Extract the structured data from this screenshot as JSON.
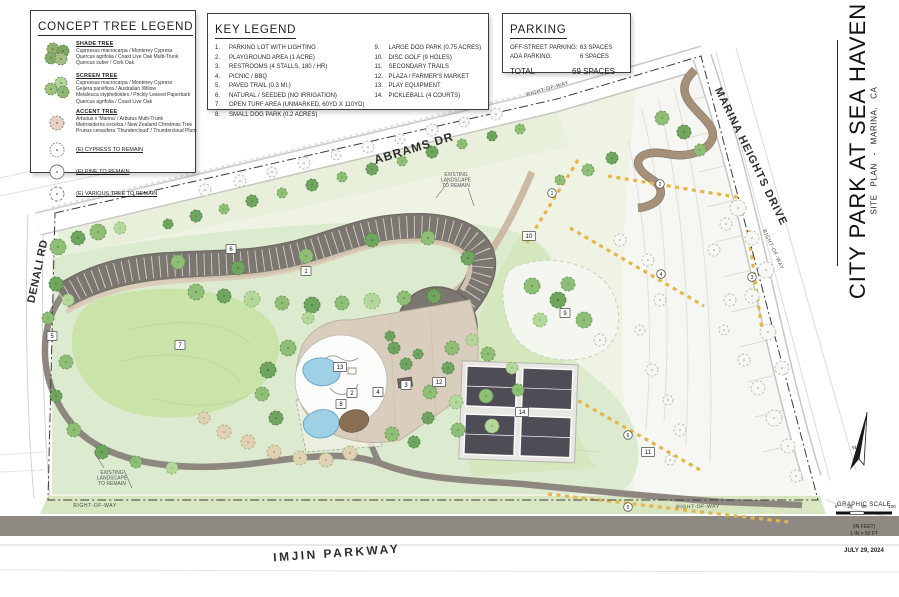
{
  "title_block": {
    "project_title": "CITY PARK AT SEA HAVEN",
    "subtitle": "SITE PLAN - MARINA, CA",
    "date": "JULY 29, 2024",
    "north_label": "N",
    "scale": {
      "heading": "GRAPHIC SCALE",
      "ticks": [
        "0",
        "25",
        "50",
        "100"
      ],
      "unit_note": "(IN FEET)",
      "ratio_note": "1 IN = 50 FT"
    }
  },
  "tree_legend": {
    "title": "CONCEPT TREE LEGEND",
    "groups": [
      {
        "name": "SHADE TREE",
        "icon": "shade-tree-cluster-icon",
        "species": [
          "Cupressus macrocarpa / Monterey Cypress",
          "Quercus agrifolia / Coast Live Oak Multi-Trunk",
          "Quercus suber / Cork Oak"
        ]
      },
      {
        "name": "SCREEN TREE",
        "icon": "screen-tree-cluster-icon",
        "species": [
          "Cupressus macrocarpa / Monterey Cypress",
          "Geijera parviflora / Australian Willow",
          "Melaleuca styphelioides / Prickly Leaved Paperbark",
          "Quercus agrifolia / Coast Live Oak"
        ]
      },
      {
        "name": "ACCENT TREE",
        "icon": "accent-tree-icon",
        "species": [
          "Arbutus x 'Marina' / Arbutus Multi-Trunk",
          "Metrosideros excelsa / New Zealand Christmas Tree",
          "Prunus cerasifera 'Thundercloud' / Thundercloud Plum"
        ]
      }
    ],
    "existing": [
      {
        "label": "(E) CYPRESS TO REMAIN",
        "icon": "existing-cypress-symbol-icon"
      },
      {
        "label": "(E) PINE TO REMAIN",
        "icon": "existing-pine-symbol-icon"
      },
      {
        "label": "(E) VARIOUS TREE TO REMAIN",
        "icon": "existing-various-symbol-icon"
      }
    ]
  },
  "key_legend": {
    "title": "KEY LEGEND",
    "items": [
      {
        "num": "1.",
        "label": "PARKING LOT WITH LIGHTING"
      },
      {
        "num": "2.",
        "label": "PLAYGROUND AREA (1 ACRE)"
      },
      {
        "num": "3.",
        "label": "RESTROOMS (4 STALLS, 180 / HR)"
      },
      {
        "num": "4.",
        "label": "PICNIC / BBQ"
      },
      {
        "num": "5.",
        "label": "PAVED TRAIL (0.3 MI.)"
      },
      {
        "num": "6.",
        "label": "NATURAL / SEEDED (NO IRRIGATION)"
      },
      {
        "num": "7.",
        "label": "OPEN TURF AREA  (UNMARKED, 60YD X 110YD)"
      },
      {
        "num": "8.",
        "label": "SMALL DOG PARK (0.2 ACRES)"
      },
      {
        "num": "9.",
        "label": "LARGE DOG PARK (0.75 ACRES)"
      },
      {
        "num": "10.",
        "label": "DISC GOLF (9 HOLES)"
      },
      {
        "num": "11.",
        "label": "SECONDARY TRAILS"
      },
      {
        "num": "12.",
        "label": "PLAZA / FARMER'S MARKET"
      },
      {
        "num": "13.",
        "label": "PLAY EQUIPMENT"
      },
      {
        "num": "14.",
        "label": "PICKLEBALL (4 COURTS)"
      }
    ]
  },
  "parking": {
    "title": "PARKING",
    "rows": [
      {
        "label": "OFF-STREET PARKING:",
        "value": "63 SPACES"
      },
      {
        "label": "ADA PARKING:",
        "value": "6 SPACES"
      }
    ],
    "total_label": "TOTAL",
    "total_value": "69 SPACES"
  },
  "map": {
    "road_labels": [
      {
        "text": "ABRAMS DR",
        "x": 415,
        "y": 152,
        "rot": -17,
        "size": 12,
        "ls": 1
      },
      {
        "text": "MARINA HEIGHTS DRIVE",
        "x": 748,
        "y": 158,
        "rot": 64,
        "size": 11,
        "ls": 1
      },
      {
        "text": "DENALI RD",
        "x": 41,
        "y": 272,
        "rot": -78,
        "size": 11,
        "ls": 0.5
      },
      {
        "text": "IMJIN PARKWAY",
        "x": 337,
        "y": 557,
        "rot": -4,
        "size": 12,
        "ls": 2.5
      }
    ],
    "row_labels": [
      {
        "text": "RIGHT-OF-WAY",
        "x": 95,
        "y": 507,
        "rot": 0
      },
      {
        "text": "RIGHT-OF-WAY",
        "x": 698,
        "y": 508,
        "rot": -1
      },
      {
        "text": "RIGHT-OF-WAY",
        "x": 772,
        "y": 250,
        "rot": 65
      },
      {
        "text": "RIGHT-OF-WAY",
        "x": 548,
        "y": 90,
        "rot": -16
      }
    ],
    "notes": [
      {
        "lines": [
          "EXISTING",
          "LANDSCAPE",
          "TO REMAIN"
        ],
        "x": 456,
        "y": 176
      },
      {
        "lines": [
          "EXISTING",
          "LANDSCAPE",
          "TO REMAIN"
        ],
        "x": 112,
        "y": 474
      }
    ],
    "markers": [
      {
        "n": "1",
        "x": 306,
        "y": 271
      },
      {
        "n": "2",
        "x": 352,
        "y": 393
      },
      {
        "n": "3",
        "x": 406,
        "y": 385
      },
      {
        "n": "4",
        "x": 378,
        "y": 392
      },
      {
        "n": "5",
        "x": 52,
        "y": 336
      },
      {
        "n": "6",
        "x": 231,
        "y": 249
      },
      {
        "n": "7",
        "x": 180,
        "y": 345
      },
      {
        "n": "8",
        "x": 341,
        "y": 404
      },
      {
        "n": "9",
        "x": 565,
        "y": 313
      },
      {
        "n": "10",
        "x": 529,
        "y": 236
      },
      {
        "n": "11",
        "x": 648,
        "y": 452
      },
      {
        "n": "12",
        "x": 439,
        "y": 382
      },
      {
        "n": "13",
        "x": 340,
        "y": 367
      },
      {
        "n": "14",
        "x": 522,
        "y": 412
      }
    ],
    "disc_golf_holes": [
      {
        "n": "1",
        "x": 552,
        "y": 193
      },
      {
        "n": "2",
        "x": 660,
        "y": 184
      },
      {
        "n": "3",
        "x": 752,
        "y": 277
      },
      {
        "n": "4",
        "x": 661,
        "y": 274
      },
      {
        "n": "5",
        "x": 628,
        "y": 507
      },
      {
        "n": "6",
        "x": 628,
        "y": 435
      }
    ],
    "trees": [
      [
        168,
        224,
        5,
        "d"
      ],
      [
        196,
        216,
        6,
        "d"
      ],
      [
        224,
        209,
        5,
        "m"
      ],
      [
        252,
        201,
        6,
        "d"
      ],
      [
        282,
        193,
        5,
        "m"
      ],
      [
        312,
        185,
        6,
        "d"
      ],
      [
        342,
        177,
        5,
        "m"
      ],
      [
        372,
        169,
        6,
        "d"
      ],
      [
        402,
        161,
        5,
        "m"
      ],
      [
        432,
        152,
        6,
        "d"
      ],
      [
        462,
        144,
        5,
        "m"
      ],
      [
        492,
        136,
        5,
        "d"
      ],
      [
        520,
        129,
        5,
        "m"
      ],
      [
        178,
        262,
        7,
        "m"
      ],
      [
        238,
        268,
        7,
        "d"
      ],
      [
        306,
        256,
        7,
        "m"
      ],
      [
        372,
        240,
        7,
        "d"
      ],
      [
        428,
        238,
        7,
        "m"
      ],
      [
        468,
        258,
        7,
        "d"
      ],
      [
        196,
        292,
        8,
        "m"
      ],
      [
        224,
        296,
        7,
        "d"
      ],
      [
        252,
        299,
        8,
        "l"
      ],
      [
        282,
        303,
        7,
        "m"
      ],
      [
        312,
        305,
        8,
        "d"
      ],
      [
        342,
        303,
        7,
        "m"
      ],
      [
        372,
        301,
        8,
        "l"
      ],
      [
        404,
        298,
        7,
        "m"
      ],
      [
        434,
        296,
        7,
        "d"
      ],
      [
        58,
        247,
        8,
        "m"
      ],
      [
        78,
        238,
        7,
        "d"
      ],
      [
        98,
        232,
        8,
        "m"
      ],
      [
        120,
        228,
        6,
        "l"
      ],
      [
        56,
        284,
        7,
        "d"
      ],
      [
        48,
        318,
        6,
        "m"
      ],
      [
        68,
        300,
        6,
        "l"
      ],
      [
        66,
        362,
        7,
        "m"
      ],
      [
        56,
        396,
        6,
        "d"
      ],
      [
        74,
        430,
        7,
        "m"
      ],
      [
        102,
        452,
        7,
        "d"
      ],
      [
        136,
        462,
        6,
        "m"
      ],
      [
        172,
        468,
        6,
        "l"
      ],
      [
        288,
        348,
        8,
        "m"
      ],
      [
        268,
        370,
        8,
        "d"
      ],
      [
        262,
        394,
        7,
        "m"
      ],
      [
        276,
        418,
        7,
        "d"
      ],
      [
        224,
        432,
        7,
        "b"
      ],
      [
        248,
        442,
        7,
        "b"
      ],
      [
        274,
        452,
        7,
        "b"
      ],
      [
        300,
        458,
        7,
        "b"
      ],
      [
        326,
        460,
        7,
        "b"
      ],
      [
        350,
        453,
        7,
        "b"
      ],
      [
        204,
        418,
        6,
        "b"
      ],
      [
        394,
        348,
        6,
        "d"
      ],
      [
        406,
        364,
        6,
        "d"
      ],
      [
        390,
        336,
        5,
        "d"
      ],
      [
        418,
        354,
        5,
        "d"
      ],
      [
        452,
        348,
        7,
        "m"
      ],
      [
        472,
        340,
        6,
        "l"
      ],
      [
        488,
        354,
        7,
        "m"
      ],
      [
        448,
        368,
        6,
        "d"
      ],
      [
        430,
        392,
        7,
        "m"
      ],
      [
        456,
        402,
        7,
        "l"
      ],
      [
        486,
        396,
        7,
        "m"
      ],
      [
        428,
        418,
        6,
        "d"
      ],
      [
        458,
        430,
        7,
        "m"
      ],
      [
        492,
        426,
        7,
        "l"
      ],
      [
        518,
        390,
        6,
        "m"
      ],
      [
        512,
        368,
        6,
        "l"
      ],
      [
        392,
        434,
        7,
        "m"
      ],
      [
        414,
        442,
        6,
        "d"
      ],
      [
        308,
        318,
        6,
        "l"
      ],
      [
        532,
        286,
        8,
        "m"
      ],
      [
        558,
        300,
        8,
        "d"
      ],
      [
        584,
        320,
        8,
        "m"
      ],
      [
        540,
        320,
        7,
        "l"
      ],
      [
        568,
        284,
        7,
        "m"
      ],
      [
        600,
        340,
        6,
        "e"
      ],
      [
        662,
        118,
        7,
        "m"
      ],
      [
        684,
        132,
        7,
        "d"
      ],
      [
        700,
        150,
        6,
        "m"
      ],
      [
        588,
        170,
        6,
        "m"
      ],
      [
        612,
        158,
        6,
        "d"
      ],
      [
        560,
        180,
        5,
        "m"
      ],
      [
        738,
        208,
        8,
        "e"
      ],
      [
        752,
        238,
        7,
        "e"
      ],
      [
        766,
        270,
        8,
        "e"
      ],
      [
        752,
        296,
        7,
        "e"
      ],
      [
        768,
        332,
        8,
        "e"
      ],
      [
        782,
        368,
        7,
        "e"
      ],
      [
        758,
        388,
        7,
        "e"
      ],
      [
        774,
        418,
        8,
        "e"
      ],
      [
        788,
        446,
        7,
        "e"
      ],
      [
        726,
        224,
        6,
        "e"
      ],
      [
        796,
        476,
        6,
        "e"
      ],
      [
        714,
        250,
        6,
        "e"
      ],
      [
        730,
        300,
        6,
        "e"
      ],
      [
        744,
        360,
        6,
        "e"
      ],
      [
        724,
        330,
        5,
        "e"
      ],
      [
        205,
        190,
        6,
        "e"
      ],
      [
        240,
        181,
        6,
        "e"
      ],
      [
        272,
        172,
        5,
        "e"
      ],
      [
        304,
        163,
        6,
        "e"
      ],
      [
        336,
        155,
        5,
        "e"
      ],
      [
        368,
        147,
        6,
        "e"
      ],
      [
        400,
        139,
        5,
        "e"
      ],
      [
        432,
        130,
        6,
        "e"
      ],
      [
        464,
        122,
        5,
        "e"
      ],
      [
        496,
        114,
        6,
        "e"
      ],
      [
        620,
        240,
        6,
        "e"
      ],
      [
        648,
        260,
        6,
        "e"
      ],
      [
        660,
        300,
        6,
        "e"
      ],
      [
        640,
        330,
        5,
        "e"
      ],
      [
        652,
        370,
        6,
        "e"
      ],
      [
        668,
        400,
        5,
        "e"
      ],
      [
        680,
        430,
        6,
        "e"
      ],
      [
        670,
        460,
        5,
        "e"
      ]
    ]
  },
  "colors": {
    "park_green": "#dcead0",
    "turf_green": "#c9e3a8",
    "natural_seeded": "#e8f0db",
    "asphalt": "#7b766f",
    "trail_gray": "#8d8780",
    "plaza_tan": "#d9cdbd",
    "water_blue": "#9ed0e6",
    "court_dark": "#4e4d56",
    "secondary_trail_yellow": "#e6b54a"
  }
}
